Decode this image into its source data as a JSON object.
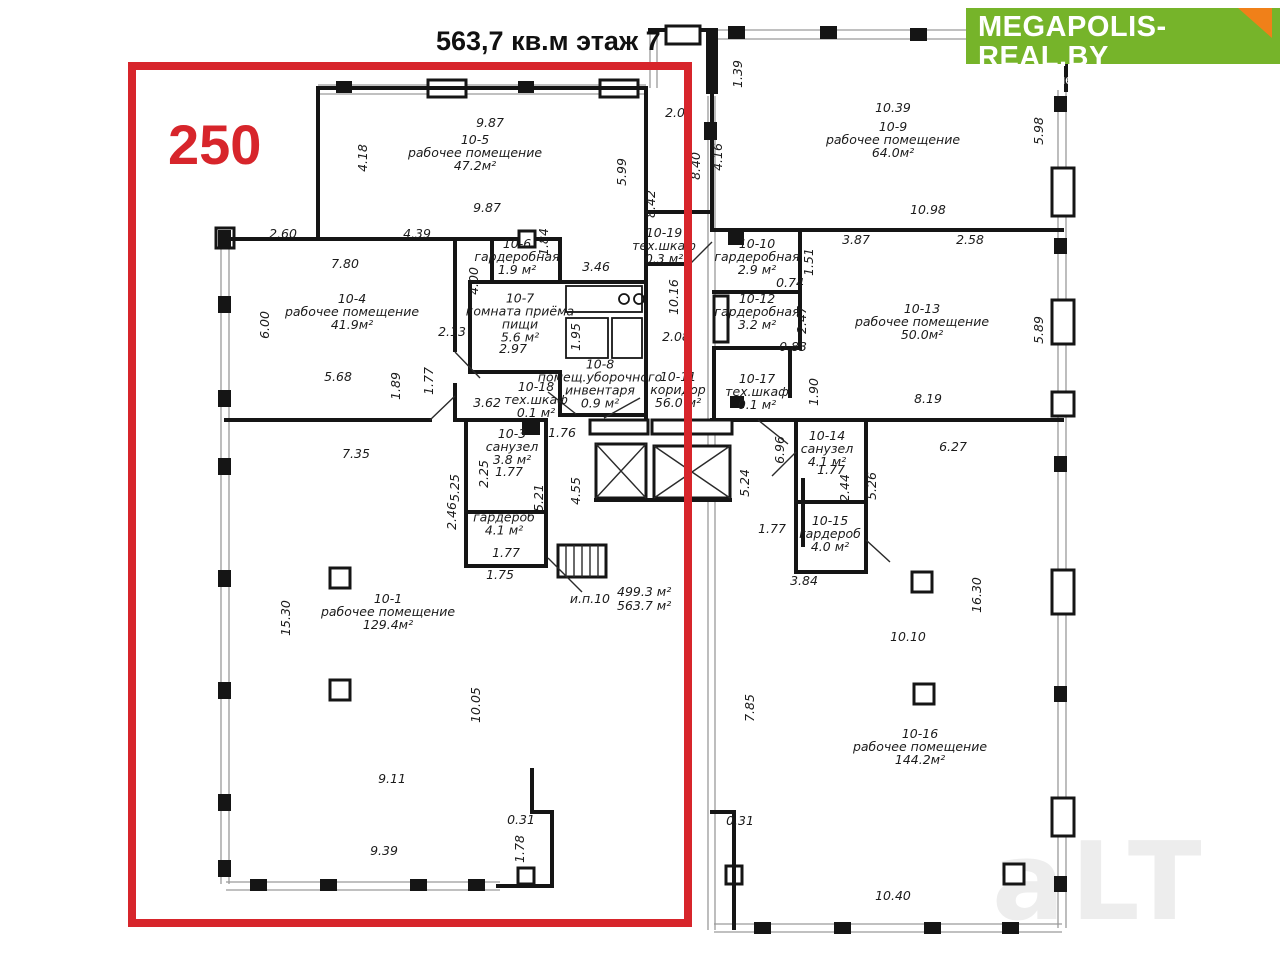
{
  "title": "563,7 кв.м этаж 7",
  "overlay": {
    "label": "250"
  },
  "logo": {
    "brand": "MEGAPOLIS-REAL.BY",
    "tagline": "портал о коммерческой недвижимости в Беларуси"
  },
  "watermark": "aLT",
  "colors": {
    "accent_red": "#d7252b",
    "logo_green": "#76b42a",
    "logo_fold_orange": "#f08019"
  },
  "note": {
    "unit": "и.п.10",
    "area1": "499.3 м²",
    "area2": "563.7 м²"
  },
  "rooms": [
    {
      "x": 475,
      "y": 153,
      "lines": [
        "10-5",
        "рабочее помещение",
        "47.2м²"
      ]
    },
    {
      "x": 352,
      "y": 312,
      "lines": [
        "10-4",
        "рабочее помещение",
        "41.9м²"
      ]
    },
    {
      "x": 517,
      "y": 257,
      "lines": [
        "10-6",
        "гардеробная",
        "1.9 м²"
      ]
    },
    {
      "x": 520,
      "y": 318,
      "lines": [
        "10-7",
        "комната приёма",
        "пищи",
        "5.6 м²"
      ]
    },
    {
      "x": 600,
      "y": 384,
      "lines": [
        "10-8",
        "помещ.уборочного",
        "инвентаря",
        "0.9 м²"
      ]
    },
    {
      "x": 536,
      "y": 400,
      "lines": [
        "10-18",
        "тех.шкаф",
        "0.1 м²"
      ]
    },
    {
      "x": 512,
      "y": 447,
      "lines": [
        "10-3",
        "санузел",
        "3.8 м²"
      ]
    },
    {
      "x": 504,
      "y": 524,
      "lines": [
        "гардероб",
        "4.1 м²"
      ]
    },
    {
      "x": 388,
      "y": 612,
      "lines": [
        "10-1",
        "рабочее помещение",
        "129.4м²"
      ]
    },
    {
      "x": 893,
      "y": 140,
      "lines": [
        "10-9",
        "рабочее помещение",
        "64.0м²"
      ]
    },
    {
      "x": 664,
      "y": 246,
      "lines": [
        "10-19",
        "тех.шкаф",
        "0.3 м²"
      ]
    },
    {
      "x": 757,
      "y": 257,
      "lines": [
        "10-10",
        "гардеробная",
        "2.9 м²"
      ]
    },
    {
      "x": 757,
      "y": 312,
      "lines": [
        "10-12",
        "гардеробная",
        "3.2 м²"
      ]
    },
    {
      "x": 678,
      "y": 390,
      "lines": [
        "10-11",
        "коридор",
        "56.0 м²"
      ]
    },
    {
      "x": 757,
      "y": 392,
      "lines": [
        "10-17",
        "тех.шкаф",
        "0.1 м²"
      ]
    },
    {
      "x": 922,
      "y": 322,
      "lines": [
        "10-13",
        "рабочее помещение",
        "50.0м²"
      ]
    },
    {
      "x": 827,
      "y": 449,
      "lines": [
        "10-14",
        "санузел",
        "4.1 м²"
      ]
    },
    {
      "x": 830,
      "y": 534,
      "lines": [
        "10-15",
        "гардероб",
        "4.0 м²"
      ]
    },
    {
      "x": 920,
      "y": 747,
      "lines": [
        "10-16",
        "рабочее помещение",
        "144.2м²"
      ]
    }
  ],
  "dimensions": [
    {
      "v": "9.87",
      "x": 490,
      "y": 127,
      "r": 0
    },
    {
      "v": "4.18",
      "x": 367,
      "y": 158,
      "r": -90
    },
    {
      "v": "5.99",
      "x": 626,
      "y": 172,
      "r": -90
    },
    {
      "v": "8.42",
      "x": 655,
      "y": 204,
      "r": -90
    },
    {
      "v": "9.87",
      "x": 487,
      "y": 212,
      "r": 0
    },
    {
      "v": "2.01",
      "x": 679,
      "y": 117,
      "r": 0
    },
    {
      "v": "1.39",
      "x": 742,
      "y": 74,
      "r": -90
    },
    {
      "v": "10.39",
      "x": 893,
      "y": 112,
      "r": 0
    },
    {
      "v": "5.98",
      "x": 1043,
      "y": 131,
      "r": -90
    },
    {
      "v": "8.40",
      "x": 700,
      "y": 166,
      "r": -90
    },
    {
      "v": "4.16",
      "x": 722,
      "y": 157,
      "r": -90
    },
    {
      "v": "10.98",
      "x": 928,
      "y": 214,
      "r": 0
    },
    {
      "v": "2.60",
      "x": 283,
      "y": 238,
      "r": 0
    },
    {
      "v": "4.39",
      "x": 417,
      "y": 238,
      "r": 0
    },
    {
      "v": "7.80",
      "x": 345,
      "y": 268,
      "r": 0
    },
    {
      "v": "6.00",
      "x": 269,
      "y": 325,
      "r": -90
    },
    {
      "v": "1.84",
      "x": 548,
      "y": 242,
      "r": -90
    },
    {
      "v": "4.00",
      "x": 478,
      "y": 281,
      "r": -90
    },
    {
      "v": "3.46",
      "x": 596,
      "y": 271,
      "r": 0
    },
    {
      "v": "10.16",
      "x": 678,
      "y": 297,
      "r": -90
    },
    {
      "v": "3.87",
      "x": 856,
      "y": 244,
      "r": 0
    },
    {
      "v": "1.51",
      "x": 813,
      "y": 262,
      "r": -90
    },
    {
      "v": "2.58",
      "x": 970,
      "y": 244,
      "r": 0
    },
    {
      "v": "0.74",
      "x": 790,
      "y": 287,
      "r": 0
    },
    {
      "v": "2.47",
      "x": 806,
      "y": 320,
      "r": -90
    },
    {
      "v": "0.83",
      "x": 793,
      "y": 351,
      "r": 0
    },
    {
      "v": "1.90",
      "x": 818,
      "y": 392,
      "r": -90
    },
    {
      "v": "5.89",
      "x": 1043,
      "y": 330,
      "r": -90
    },
    {
      "v": "2.13",
      "x": 452,
      "y": 336,
      "r": 0
    },
    {
      "v": "2.97",
      "x": 513,
      "y": 353,
      "r": 0
    },
    {
      "v": "1.95",
      "x": 580,
      "y": 337,
      "r": -90
    },
    {
      "v": "2.08",
      "x": 676,
      "y": 341,
      "r": 0
    },
    {
      "v": "5.68",
      "x": 338,
      "y": 381,
      "r": 0
    },
    {
      "v": "1.89",
      "x": 400,
      "y": 386,
      "r": -90
    },
    {
      "v": "1.77",
      "x": 433,
      "y": 381,
      "r": -90
    },
    {
      "v": "3.62",
      "x": 487,
      "y": 407,
      "r": 0
    },
    {
      "v": "1.76",
      "x": 562,
      "y": 437,
      "r": 0
    },
    {
      "v": "8.19",
      "x": 928,
      "y": 403,
      "r": 0
    },
    {
      "v": "2.25",
      "x": 488,
      "y": 474,
      "r": -90
    },
    {
      "v": "1.77",
      "x": 509,
      "y": 476,
      "r": 0
    },
    {
      "v": "5.25",
      "x": 459,
      "y": 488,
      "r": -90
    },
    {
      "v": "5.21",
      "x": 543,
      "y": 498,
      "r": -90
    },
    {
      "v": "2.46",
      "x": 456,
      "y": 516,
      "r": -90
    },
    {
      "v": "4.55",
      "x": 580,
      "y": 491,
      "r": -90
    },
    {
      "v": "6.96",
      "x": 784,
      "y": 450,
      "r": -90
    },
    {
      "v": "5.24",
      "x": 749,
      "y": 483,
      "r": -90
    },
    {
      "v": "6.27",
      "x": 953,
      "y": 451,
      "r": 0
    },
    {
      "v": "1.77",
      "x": 831,
      "y": 474,
      "r": 0
    },
    {
      "v": "2.44",
      "x": 849,
      "y": 488,
      "r": -90
    },
    {
      "v": "5.26",
      "x": 876,
      "y": 486,
      "r": -90
    },
    {
      "v": "7.35",
      "x": 356,
      "y": 458,
      "r": 0
    },
    {
      "v": "1.77",
      "x": 506,
      "y": 557,
      "r": 0
    },
    {
      "v": "1.75",
      "x": 500,
      "y": 579,
      "r": 0
    },
    {
      "v": "1.77",
      "x": 772,
      "y": 533,
      "r": 0
    },
    {
      "v": "3.84",
      "x": 804,
      "y": 585,
      "r": 0
    },
    {
      "v": "15.30",
      "x": 290,
      "y": 618,
      "r": -90
    },
    {
      "v": "16.30",
      "x": 981,
      "y": 595,
      "r": -90
    },
    {
      "v": "10.10",
      "x": 908,
      "y": 641,
      "r": 0
    },
    {
      "v": "10.05",
      "x": 480,
      "y": 705,
      "r": -90
    },
    {
      "v": "7.85",
      "x": 754,
      "y": 708,
      "r": -90
    },
    {
      "v": "9.11",
      "x": 392,
      "y": 783,
      "r": 0
    },
    {
      "v": "9.39",
      "x": 384,
      "y": 855,
      "r": 0
    },
    {
      "v": "0.31",
      "x": 521,
      "y": 824,
      "r": 0
    },
    {
      "v": "1.78",
      "x": 524,
      "y": 849,
      "r": -90
    },
    {
      "v": "0.31",
      "x": 740,
      "y": 825,
      "r": 0
    },
    {
      "v": "10.40",
      "x": 893,
      "y": 900,
      "r": 0
    }
  ]
}
